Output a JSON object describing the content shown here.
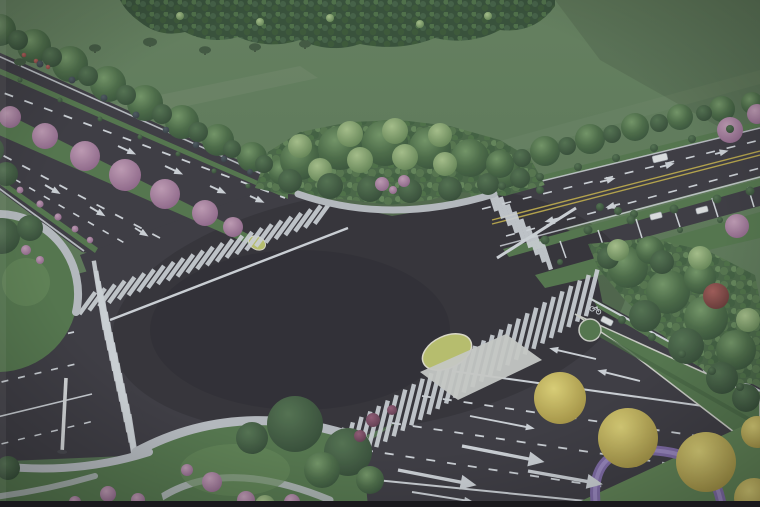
{
  "meta": {
    "title": "Aerial rendering of a landscaped four-way road intersection",
    "description": "Bird's-eye architectural rendering: two boulevards with planted medians cross at a large dark asphalt intersection surrounded by tree-lined verges, zebra crosswalks, lane arrows, a grass field and forest belt at the horizon"
  },
  "palette": {
    "field": "#5e7a57",
    "fieldLo": "#4e6b4b",
    "forestBase": "#2e4830",
    "grass": "#4c6f45",
    "grassLight": "#5a7e4e",
    "grassBright": "#5d8250",
    "capGrass": "#b7bd67",
    "asphalt": "#34323a",
    "marking": "#ccd0d6",
    "yellowLine": "#b3a042",
    "sidewalk": "#b4b8bd",
    "curb": "#d8d6c6",
    "purple": "#7a64a4",
    "purpleLight": "#9e8ac4",
    "carWhite": "#dcdee0",
    "photoEdge": "#1a191d",
    "washOverlay": "#b6bcc2",
    "canopyHi": "#6d9160",
    "canopyMid": "#44653f",
    "canopyLo": "#2e4a30",
    "darkTreeHi": "#4c6c49",
    "darkTreeLo": "#2b432d",
    "lightTreeHi": "#a3bd85",
    "lightTreeLo": "#5d7f4d",
    "pinkHi": "#bd97b1",
    "pinkLo": "#8a5f84",
    "yellowHi": "#dccf70",
    "yellowLo": "#a08d3a",
    "redHi": "#9c5450",
    "redLo": "#5f2f2d",
    "redBushHi": "#8d5570",
    "redBushLo": "#5a3348",
    "dotHi": "#46525a",
    "dotLo": "#2c343a",
    "redSpeckHi": "#b05a55",
    "redSpeckLo": "#7e3a36"
  },
  "scene": {
    "crosswalks": [
      {
        "name": "upper-left-road",
        "cx": 205,
        "cy": 258,
        "stack": -21,
        "pitch": 10.5,
        "count": 25,
        "tick": 36,
        "len": 27
      },
      {
        "name": "lower-left-road",
        "cx": 117,
        "cy": 372,
        "stack": 77,
        "pitch": 10.5,
        "count": 16,
        "tick": -9,
        "len": 70
      },
      {
        "name": "bottom-right-road",
        "cx": 465,
        "cy": 372,
        "stack": -32,
        "pitch": 10.3,
        "count": 30,
        "tick": 14,
        "len": 48
      },
      {
        "name": "right-road",
        "cx": 519,
        "cy": 226,
        "stack": 47,
        "pitch": 10,
        "count": 9,
        "tick": -18,
        "len": 30
      }
    ],
    "arrows": [
      [
        118,
        146,
        25,
        20,
        "t"
      ],
      [
        165,
        166,
        25,
        20,
        "t"
      ],
      [
        210,
        186,
        25,
        18,
        "t"
      ],
      [
        250,
        196,
        25,
        16,
        "t"
      ],
      [
        45,
        185,
        30,
        18,
        "t"
      ],
      [
        90,
        207,
        31,
        18,
        "t"
      ],
      [
        135,
        228,
        32,
        16,
        "t"
      ],
      [
        600,
        182,
        -14,
        16,
        "t"
      ],
      [
        660,
        167,
        -14,
        15,
        "t"
      ],
      [
        715,
        154,
        -14,
        14,
        "t"
      ],
      [
        560,
        218,
        166,
        16,
        "t"
      ],
      [
        620,
        204,
        166,
        15,
        "t"
      ],
      [
        398,
        470,
        11,
        80,
        "b"
      ],
      [
        462,
        446,
        11,
        84,
        "b"
      ],
      [
        528,
        471,
        10,
        76,
        "b"
      ],
      [
        412,
        492,
        9,
        62,
        "t"
      ],
      [
        470,
        416,
        11,
        66,
        "t"
      ],
      [
        596,
        359,
        193,
        48,
        "t"
      ],
      [
        640,
        381,
        194,
        44,
        "t"
      ]
    ],
    "trees": [
      [
        20,
        62,
        6,
        "sil"
      ],
      [
        55,
        57,
        6,
        "sil"
      ],
      [
        95,
        48,
        6,
        "sil"
      ],
      [
        150,
        42,
        7,
        "sil"
      ],
      [
        205,
        50,
        6,
        "sil"
      ],
      [
        255,
        47,
        6,
        "sil"
      ],
      [
        305,
        44,
        6,
        "sil"
      ],
      [
        180,
        16,
        4,
        "l"
      ],
      [
        260,
        22,
        4,
        "l"
      ],
      [
        330,
        18,
        4,
        "l"
      ],
      [
        420,
        24,
        4,
        "l"
      ],
      [
        488,
        16,
        4,
        "l"
      ],
      [
        0,
        30,
        16,
        "g"
      ],
      [
        34,
        46,
        17,
        "g"
      ],
      [
        70,
        64,
        18,
        "g"
      ],
      [
        108,
        84,
        18,
        "g"
      ],
      [
        145,
        103,
        18,
        "g"
      ],
      [
        182,
        122,
        17,
        "g"
      ],
      [
        218,
        140,
        16,
        "g"
      ],
      [
        252,
        157,
        15,
        "g"
      ],
      [
        282,
        172,
        13,
        "g"
      ],
      [
        18,
        40,
        10,
        "d"
      ],
      [
        52,
        57,
        10,
        "d"
      ],
      [
        88,
        76,
        10,
        "d"
      ],
      [
        126,
        95,
        10,
        "d"
      ],
      [
        162,
        114,
        10,
        "d"
      ],
      [
        198,
        132,
        10,
        "d"
      ],
      [
        232,
        149,
        9,
        "d"
      ],
      [
        264,
        164,
        9,
        "d"
      ],
      [
        24,
        55,
        2.3,
        "red"
      ],
      [
        36,
        61,
        2.3,
        "red"
      ],
      [
        48,
        67,
        2.2,
        "red"
      ],
      [
        40,
        64,
        3.5,
        "dot"
      ],
      [
        72,
        80,
        3.5,
        "dot"
      ],
      [
        104,
        98,
        3.5,
        "dot"
      ],
      [
        136,
        115,
        3.5,
        "dot"
      ],
      [
        166,
        130,
        3.3,
        "dot"
      ],
      [
        196,
        145,
        3.3,
        "dot"
      ],
      [
        224,
        159,
        3.2,
        "dot"
      ],
      [
        250,
        172,
        3,
        "dot"
      ],
      [
        20,
        80,
        2.5,
        "s"
      ],
      [
        60,
        100,
        2.5,
        "s"
      ],
      [
        100,
        119,
        2.5,
        "s"
      ],
      [
        140,
        137,
        2.5,
        "s"
      ],
      [
        178,
        154,
        2.5,
        "s"
      ],
      [
        214,
        171,
        2.5,
        "s"
      ],
      [
        248,
        186,
        2.5,
        "s"
      ],
      [
        10,
        117,
        11,
        "p"
      ],
      [
        45,
        136,
        13,
        "p"
      ],
      [
        85,
        156,
        15,
        "p"
      ],
      [
        125,
        175,
        16,
        "p"
      ],
      [
        165,
        194,
        15,
        "p"
      ],
      [
        205,
        213,
        13,
        "p"
      ],
      [
        233,
        227,
        10,
        "p"
      ],
      [
        0,
        176,
        3,
        "pb"
      ],
      [
        20,
        190,
        3.4,
        "pb"
      ],
      [
        40,
        204,
        3.6,
        "pb"
      ],
      [
        58,
        217,
        3.6,
        "pb"
      ],
      [
        75,
        229,
        3.4,
        "pb"
      ],
      [
        90,
        240,
        3.2,
        "pb"
      ],
      [
        -10,
        150,
        14,
        "d"
      ],
      [
        6,
        174,
        12,
        "d"
      ],
      [
        2,
        236,
        18,
        "d"
      ],
      [
        30,
        228,
        13,
        "d"
      ],
      [
        -14,
        262,
        10,
        "l"
      ],
      [
        26,
        250,
        5,
        "pb"
      ],
      [
        40,
        260,
        4,
        "pb"
      ],
      [
        300,
        160,
        20,
        "g"
      ],
      [
        340,
        148,
        22,
        "g"
      ],
      [
        385,
        143,
        23,
        "g"
      ],
      [
        430,
        148,
        21,
        "g"
      ],
      [
        470,
        158,
        19,
        "g"
      ],
      [
        505,
        172,
        16,
        "g"
      ],
      [
        300,
        146,
        12,
        "l"
      ],
      [
        350,
        134,
        13,
        "l"
      ],
      [
        395,
        131,
        13,
        "l"
      ],
      [
        440,
        135,
        12,
        "l"
      ],
      [
        320,
        170,
        12,
        "l"
      ],
      [
        360,
        160,
        13,
        "l"
      ],
      [
        405,
        157,
        13,
        "l"
      ],
      [
        445,
        164,
        12,
        "l"
      ],
      [
        290,
        181,
        12,
        "d"
      ],
      [
        330,
        186,
        13,
        "d"
      ],
      [
        370,
        189,
        13,
        "d"
      ],
      [
        410,
        191,
        12,
        "d"
      ],
      [
        450,
        189,
        12,
        "d"
      ],
      [
        488,
        184,
        11,
        "d"
      ],
      [
        520,
        178,
        10,
        "d"
      ],
      [
        382,
        184,
        7,
        "p"
      ],
      [
        404,
        181,
        6,
        "p"
      ],
      [
        393,
        190,
        4,
        "pb"
      ],
      [
        540,
        190,
        4,
        "s"
      ],
      [
        600,
        207,
        4,
        "s"
      ],
      [
        618,
        211,
        4,
        "s"
      ],
      [
        634,
        214,
        4,
        "s"
      ],
      [
        500,
        164,
        14,
        "g"
      ],
      [
        545,
        151,
        15,
        "g"
      ],
      [
        590,
        139,
        15,
        "g"
      ],
      [
        635,
        127,
        14,
        "g"
      ],
      [
        680,
        117,
        13,
        "g"
      ],
      [
        722,
        109,
        13,
        "g"
      ],
      [
        752,
        103,
        11,
        "g"
      ],
      [
        522,
        158,
        9,
        "d"
      ],
      [
        567,
        146,
        9,
        "d"
      ],
      [
        612,
        134,
        9,
        "d"
      ],
      [
        659,
        123,
        9,
        "d"
      ],
      [
        704,
        113,
        8,
        "d"
      ],
      [
        730,
        130,
        13,
        "p"
      ],
      [
        757,
        114,
        10,
        "p"
      ],
      [
        502,
        186,
        4,
        "s"
      ],
      [
        540,
        177,
        4,
        "s"
      ],
      [
        578,
        167,
        4,
        "s"
      ],
      [
        616,
        158,
        4,
        "s"
      ],
      [
        654,
        148,
        4,
        "s"
      ],
      [
        692,
        139,
        4,
        "s"
      ],
      [
        730,
        129,
        4,
        "s"
      ],
      [
        545,
        240,
        4.5,
        "s"
      ],
      [
        588,
        230,
        4.5,
        "s"
      ],
      [
        631,
        220,
        4.5,
        "s"
      ],
      [
        674,
        209,
        4.5,
        "s"
      ],
      [
        717,
        199,
        4.5,
        "s"
      ],
      [
        750,
        191,
        4.5,
        "s"
      ],
      [
        560,
        262,
        3,
        "s"
      ],
      [
        600,
        252,
        3,
        "s"
      ],
      [
        640,
        241,
        3,
        "s"
      ],
      [
        680,
        230,
        3,
        "s"
      ],
      [
        720,
        220,
        3,
        "s"
      ],
      [
        628,
        268,
        20,
        "g"
      ],
      [
        668,
        292,
        22,
        "g"
      ],
      [
        706,
        318,
        22,
        "g"
      ],
      [
        736,
        350,
        20,
        "g"
      ],
      [
        700,
        278,
        16,
        "g"
      ],
      [
        650,
        250,
        14,
        "g"
      ],
      [
        645,
        316,
        16,
        "d"
      ],
      [
        686,
        346,
        18,
        "d"
      ],
      [
        722,
        378,
        16,
        "d"
      ],
      [
        662,
        262,
        12,
        "d"
      ],
      [
        608,
        258,
        11,
        "d"
      ],
      [
        746,
        398,
        14,
        "d"
      ],
      [
        618,
        250,
        11,
        "l"
      ],
      [
        700,
        258,
        12,
        "l"
      ],
      [
        748,
        320,
        12,
        "l"
      ],
      [
        716,
        296,
        13,
        "r"
      ],
      [
        737,
        226,
        12,
        "p"
      ],
      [
        622,
        320,
        4,
        "s"
      ],
      [
        652,
        337,
        4,
        "s"
      ],
      [
        682,
        354,
        4,
        "s"
      ],
      [
        712,
        371,
        4,
        "s"
      ],
      [
        740,
        387,
        4,
        "s"
      ],
      [
        295,
        424,
        28,
        "d"
      ],
      [
        348,
        452,
        24,
        "d"
      ],
      [
        252,
        438,
        16,
        "d"
      ],
      [
        322,
        470,
        18,
        "g"
      ],
      [
        370,
        480,
        14,
        "g"
      ],
      [
        212,
        482,
        10,
        "pb"
      ],
      [
        246,
        500,
        9,
        "pb"
      ],
      [
        187,
        470,
        6,
        "pb"
      ],
      [
        292,
        502,
        8,
        "pb"
      ],
      [
        265,
        505,
        10,
        "l"
      ],
      [
        8,
        468,
        12,
        "d"
      ],
      [
        108,
        494,
        8,
        "pb"
      ],
      [
        138,
        500,
        7,
        "pb"
      ],
      [
        75,
        502,
        6,
        "pb"
      ],
      [
        560,
        398,
        26,
        "y"
      ],
      [
        628,
        438,
        30,
        "y"
      ],
      [
        706,
        462,
        30,
        "y"
      ],
      [
        754,
        498,
        20,
        "y"
      ],
      [
        757,
        432,
        16,
        "y"
      ],
      [
        373,
        420,
        7,
        "rb"
      ],
      [
        360,
        436,
        6,
        "rb"
      ],
      [
        392,
        410,
        5,
        "rb"
      ]
    ],
    "cars": [
      [
        660,
        158,
        15,
        7,
        -13
      ],
      [
        607,
        321,
        12,
        6,
        27
      ],
      [
        702,
        210,
        12,
        6,
        -14
      ],
      [
        656,
        216,
        12,
        6,
        -14
      ]
    ],
    "poles": [
      {
        "x": 66,
        "y": 378,
        "h": 72
      }
    ]
  }
}
